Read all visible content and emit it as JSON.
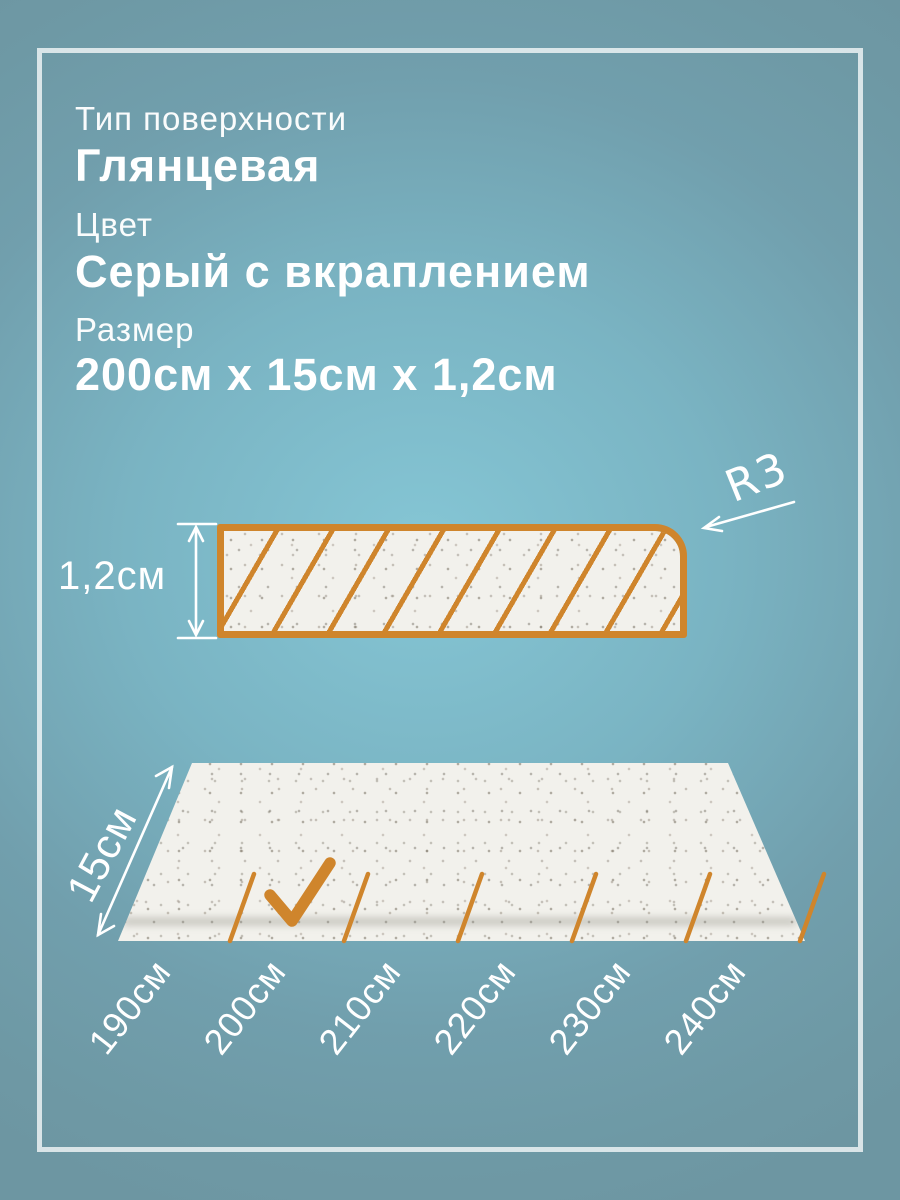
{
  "specs": {
    "surface_label": "Тип поверхности",
    "surface_value": "Глянцевая",
    "color_label": "Цвет",
    "color_value": "Серый с вкраплением",
    "size_label": "Размер",
    "size_value": "200см x 15см x 1,2см"
  },
  "cross_section": {
    "thickness_label": "1,2см",
    "corner_radius_label": "R3"
  },
  "plan_view": {
    "width_label": "15см",
    "length_options": [
      "190см",
      "200см",
      "210см",
      "220см",
      "230см",
      "240см"
    ],
    "selected_length": "200см"
  },
  "colors": {
    "accent_orange": "#CF852C",
    "background_center": "#85C6D5",
    "background_edge": "#6D96A2",
    "frame_border": "#DCE7EB",
    "board_fill": "#F2F1EC",
    "text": "#FFFFFF"
  }
}
